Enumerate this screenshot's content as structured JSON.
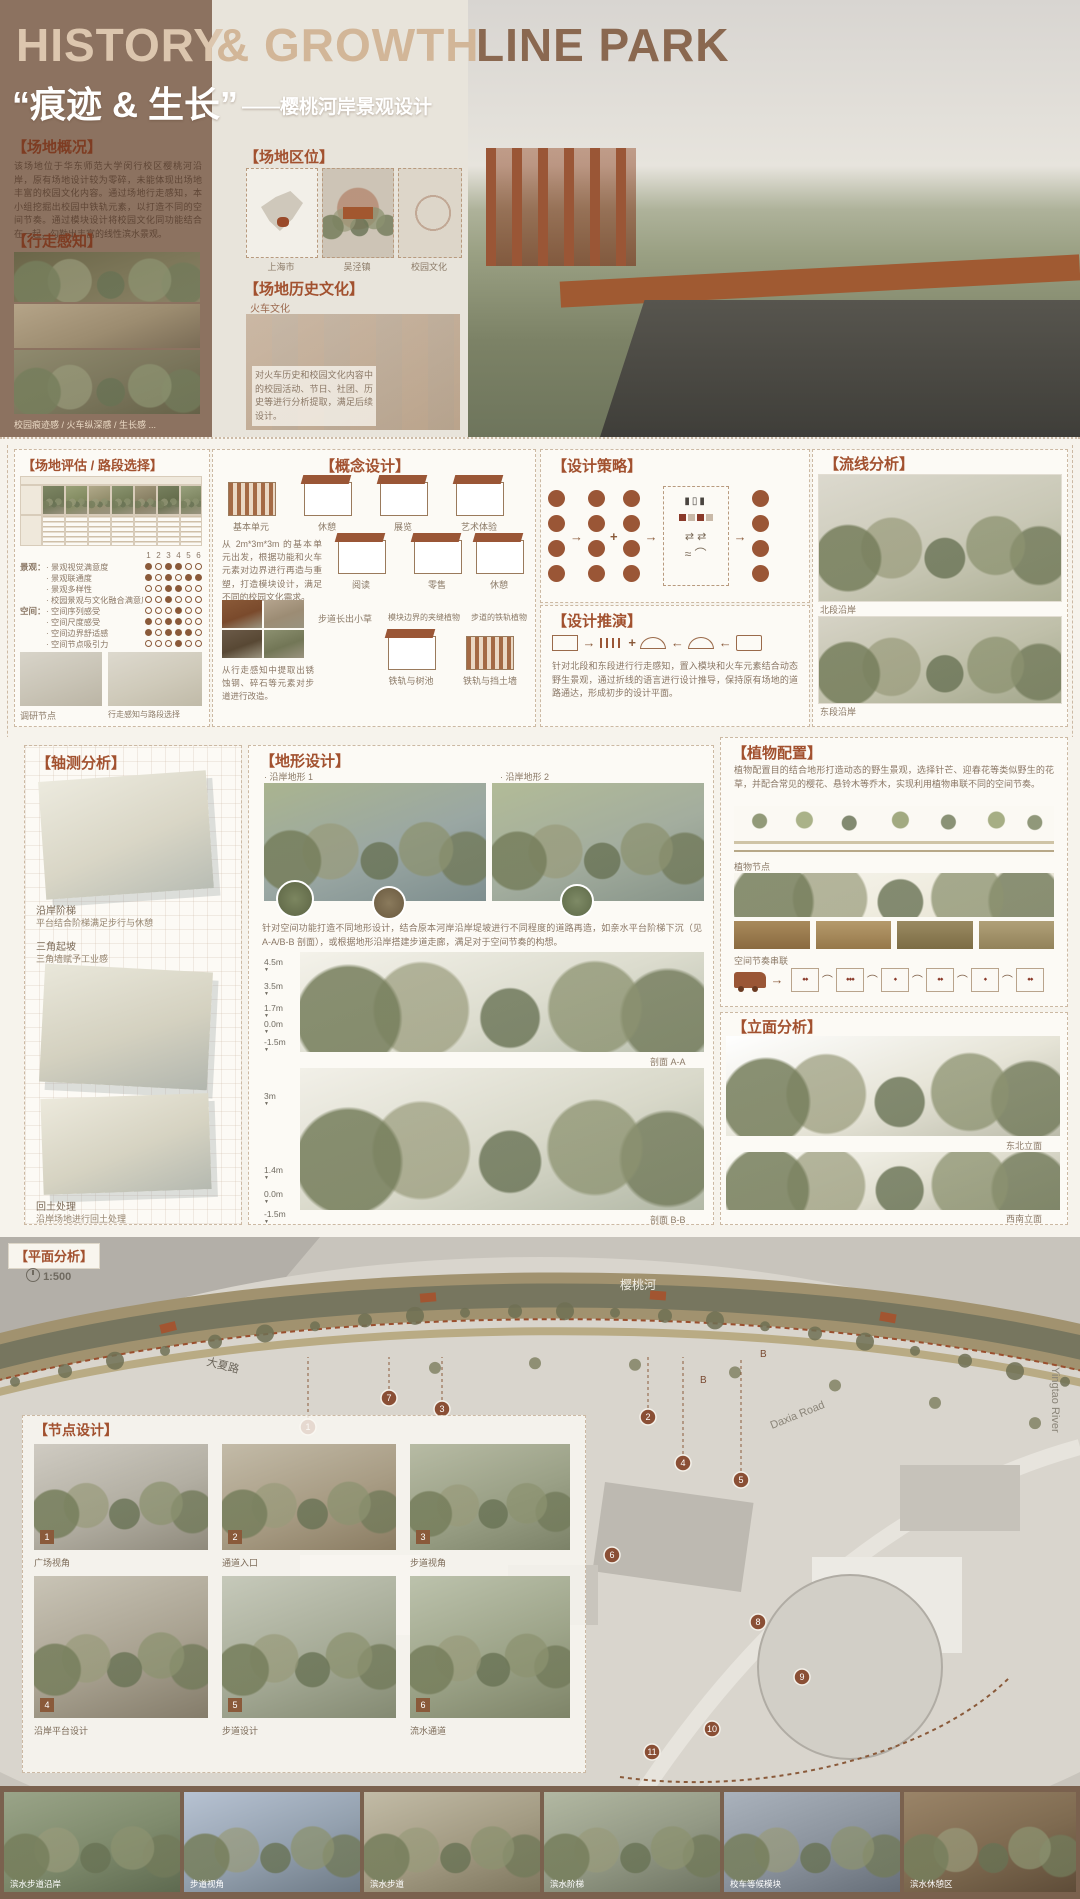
{
  "header": {
    "title_part1": "HISTORY",
    "title_part2": "& GROWTH",
    "title_part3": "LINE PARK",
    "subtitle_cn": "“痕迹 & 生长”",
    "subtitle_dash": "——樱桃河岸景观设计"
  },
  "site_overview": {
    "heading": "【场地概况】",
    "body": "该场地位于华东师范大学闵行校区樱桃河沿岸，原有场地设计较为零碎，未能体现出场地丰富的校园文化内容。通过场地行走感知，本小组挖掘出校园中铁轨元素，以打造不同的空间节奏。通过模块设计将校园文化同功能结合在一起，勾勒出丰富的线性滨水景观。"
  },
  "walking": {
    "heading": "【行走感知】",
    "caption": "校园痕迹感 / 火车纵深感 / 生长感 ..."
  },
  "location": {
    "heading": "【场地区位】",
    "maps": [
      {
        "label": "上海市"
      },
      {
        "label": "吴泾镇"
      },
      {
        "label": "校园文化"
      }
    ]
  },
  "history": {
    "heading": "【场地历史文化】",
    "label_left": "火车文化",
    "body": "对火车历史和校园文化内容中的校园活动、节日、社团、历史等进行分析提取，满足后续设计。"
  },
  "render_caption": "效果图",
  "evaluation": {
    "heading": "【场地评估 / 路段选择】",
    "columns": [
      "1",
      "2",
      "3",
      "4",
      "5",
      "6"
    ],
    "groups": [
      {
        "name": "景观：",
        "items": [
          {
            "label": "景观视觉满意度",
            "dots": [
              1,
              0,
              1,
              1,
              0,
              0
            ]
          },
          {
            "label": "景观联通度",
            "dots": [
              1,
              0,
              1,
              0,
              1,
              1
            ]
          },
          {
            "label": "景观多样性",
            "dots": [
              0,
              0,
              1,
              1,
              0,
              0
            ]
          },
          {
            "label": "校园景观与文化融合满意度",
            "dots": [
              0,
              0,
              1,
              0,
              0,
              0
            ]
          }
        ]
      },
      {
        "name": "空间：",
        "items": [
          {
            "label": "空间序列感受",
            "dots": [
              0,
              0,
              0,
              1,
              0,
              0
            ]
          },
          {
            "label": "空间尺度感受",
            "dots": [
              1,
              0,
              1,
              1,
              0,
              0
            ]
          },
          {
            "label": "空间边界舒适感",
            "dots": [
              1,
              0,
              1,
              1,
              1,
              0
            ]
          },
          {
            "label": "空间节点吸引力",
            "dots": [
              0,
              0,
              0,
              1,
              0,
              0
            ]
          }
        ]
      }
    ],
    "caption_left": "调研节点",
    "caption_right": "行走感知与路段选择"
  },
  "concept": {
    "heading": "【概念设计】",
    "modules_row1": [
      "基本单元",
      "休憩",
      "展览",
      "艺术体验"
    ],
    "modules_row2": [
      "阅读",
      "零售",
      "休憩"
    ],
    "body1": "从 2m*3m*3m 的基本单元出发，根据功能和火车元素对边界进行再造与重塑，打造模块设计，满足不同的校园文化需求。",
    "texture_labels": [
      "步道长出小草",
      "模块边界的夹缝植物",
      "步道的铁轨植物"
    ],
    "body2": "从行走感知中提取出锈蚀钢、碎石等元素对步道进行改造。",
    "bottom_labels": [
      "铁轨与树池",
      "铁轨与挡土墙"
    ]
  },
  "strategy": {
    "heading": "【设计策略】"
  },
  "derivation": {
    "heading": "【设计推演】",
    "body": "针对北段和东段进行行走感知，置入模块和火车元素结合动态野生景观，通过折线的语言进行设计推导，保持原有场地的道路通达，形成初步的设计平面。"
  },
  "circulation": {
    "heading": "【流线分析】",
    "caption_north": "北段沿岸",
    "caption_east": "东段沿岸"
  },
  "axon": {
    "heading": "【轴测分析】",
    "items": [
      {
        "label": "沿岸阶梯",
        "desc": "平台结合阶梯满足步行与休憩"
      },
      {
        "label": "三角起坡",
        "desc": "三角墙赋予工业感"
      },
      {
        "label": "回土处理",
        "desc": "沿岸场地进行回土处理"
      }
    ]
  },
  "terrain": {
    "heading": "【地形设计】",
    "sub1": "· 沿岸地形 1",
    "sub2": "· 沿岸地形 2",
    "body": "针对空间功能打造不同地形设计，结合原本河岸沿岸堤坡进行不同程度的道路再造，如亲水平台阶梯下沉（见 A-A/B-B 剖面），或根据地形沿岸搭建步道走廊，满足对于空间节奏的构想。",
    "sectionA": {
      "elevations": [
        "4.5m",
        "3.5m",
        "1.7m",
        "0.0m",
        "-1.5m"
      ],
      "label": "剖面 A-A"
    },
    "sectionB": {
      "elevations": [
        "3m",
        "1.4m",
        "0.0m",
        "-1.5m"
      ],
      "label": "剖面 B-B"
    }
  },
  "planting": {
    "heading": "【植物配置】",
    "body": "植物配置目的结合地形打造动态的野生景观，选择针芒、迎春花等类似野生的花草，并配合常见的樱花、悬铃木等乔木，实现利用植物串联不同的空间节奏。",
    "sub1": "植物节点",
    "sub2": "空间节奏串联"
  },
  "elevation_section": {
    "heading": "【立面分析】",
    "caption1": "东北立面",
    "caption2": "西南立面"
  },
  "plan": {
    "heading": "【平面分析】",
    "scale": "1:500",
    "river_label": "樱桃河",
    "road_cn": "大夏路",
    "road_en": "Daxia Road",
    "river_en": "Yingtao River",
    "section_marker": "B",
    "nodes": [
      "1",
      "2",
      "3",
      "4",
      "5",
      "6",
      "7",
      "8",
      "9",
      "10",
      "11"
    ]
  },
  "node_design": {
    "heading": "【节点设计】",
    "items": [
      {
        "num": "1",
        "label": "广场视角"
      },
      {
        "num": "2",
        "label": "通道入口"
      },
      {
        "num": "3",
        "label": "步道视角"
      },
      {
        "num": "4",
        "label": "沿岸平台设计"
      },
      {
        "num": "5",
        "label": "步道设计"
      },
      {
        "num": "6",
        "label": "流水通道"
      }
    ]
  },
  "bottom_strip": {
    "photos": [
      {
        "caption": "滨水步道沿岸"
      },
      {
        "caption": "步道视角"
      },
      {
        "caption": "滨水步道"
      },
      {
        "caption": "滨水阶梯"
      },
      {
        "caption": "校车等候模块"
      },
      {
        "caption": "滨水休憩区"
      }
    ]
  },
  "colors": {
    "brown": "#8c7260",
    "accent": "#a2512f",
    "rust": "#9a5636",
    "panel_border": "#ccb9a3"
  }
}
